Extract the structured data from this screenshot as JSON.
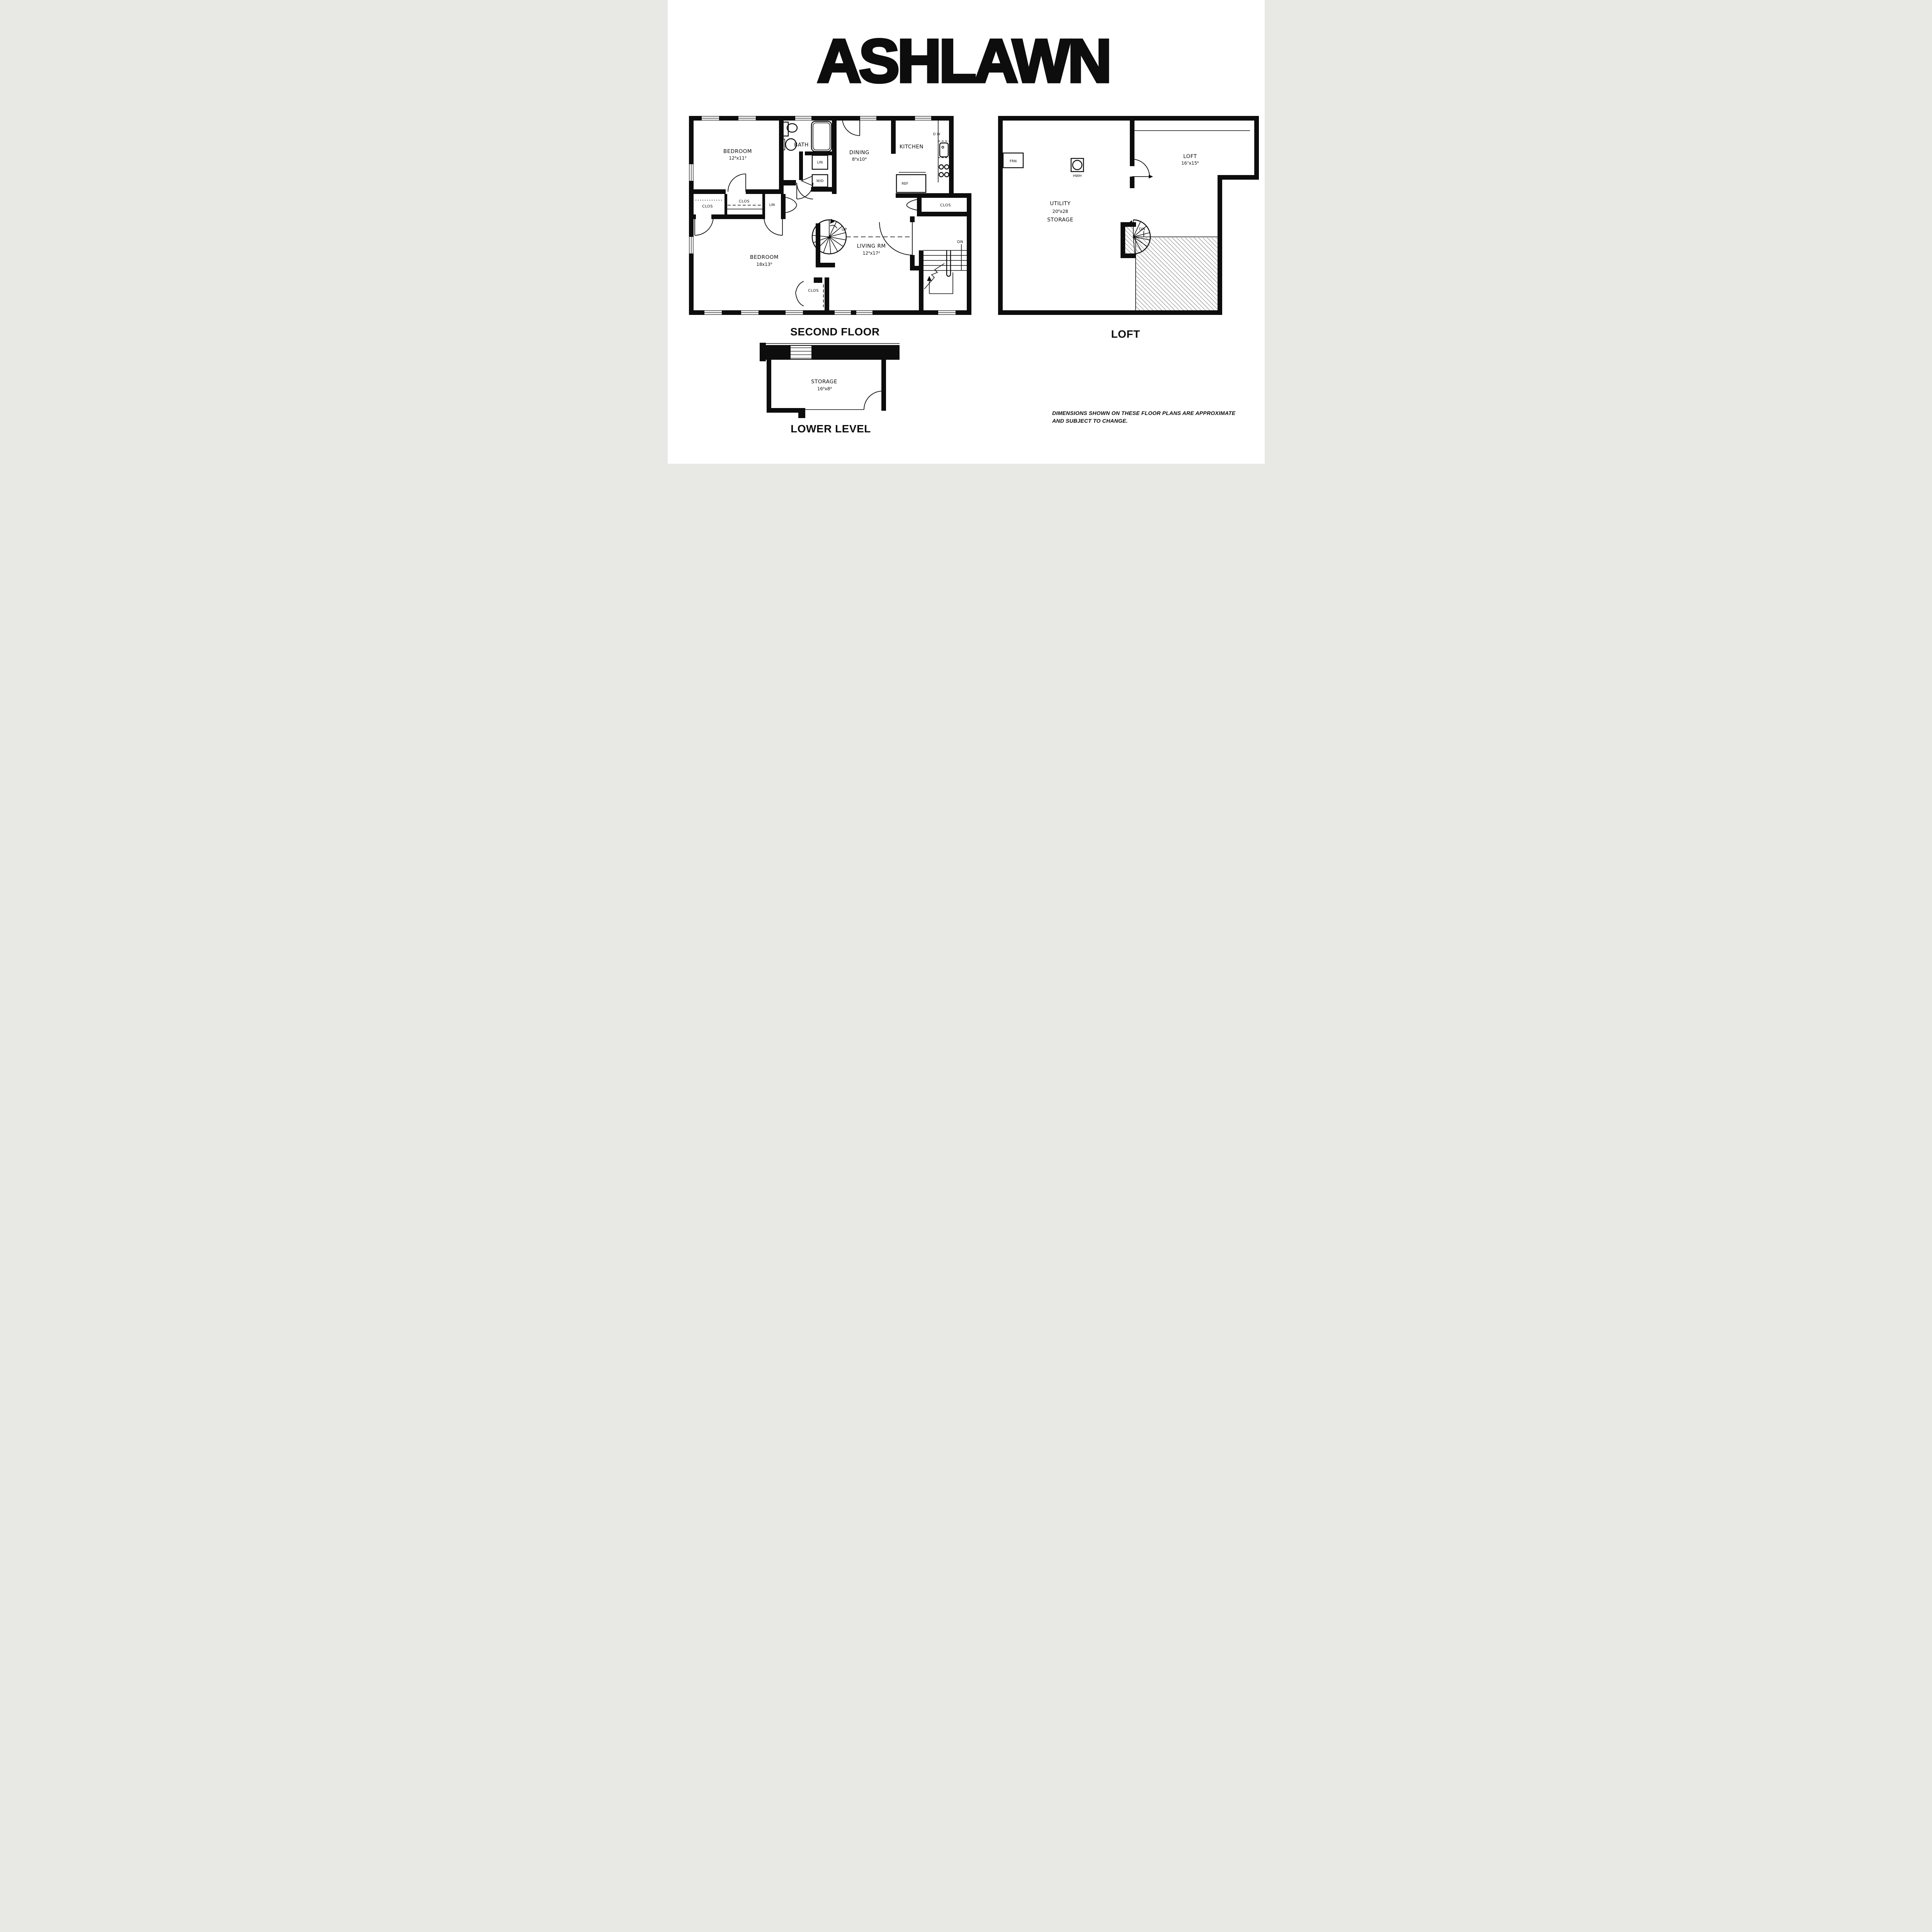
{
  "title": "ASHLAWN",
  "second_floor": {
    "label": "SECOND FLOOR",
    "bedroom1": {
      "name": "BEDROOM",
      "dims": "12⁶x11³"
    },
    "bath": {
      "name": "BATH"
    },
    "lin_upper": "LIN",
    "wd": "W/D",
    "dining": {
      "name": "DINING",
      "dims": "8⁹x10⁶"
    },
    "kitchen": {
      "name": "KITCHEN"
    },
    "dw": "D W",
    "ref": "REF",
    "clos_left": "CLOS",
    "clos_mid": "CLOS",
    "lin_mid": "LIN",
    "clos_entry": "CLOS",
    "bedroom2": {
      "name": "BEDROOM",
      "dims": "18x13⁹"
    },
    "living": {
      "name": "LIVING RM",
      "dims": "12⁶x17²"
    },
    "clos_bedroom2": "CLOS",
    "up": "UP",
    "dn": "DN"
  },
  "loft": {
    "label": "LOFT",
    "frn": "FRN",
    "hwh": "HWH",
    "utility": {
      "line1": "UTILITY",
      "dims": "20⁶x28",
      "line2": "STORAGE"
    },
    "loft_room": {
      "name": "LOFT",
      "dims": "16⁷x15⁶"
    },
    "dn": "DN"
  },
  "lower_level": {
    "label": "LOWER LEVEL",
    "storage": {
      "name": "STORAGE",
      "dims": "16⁶x8⁶"
    }
  },
  "note": {
    "line1": "DIMENSIONS SHOWN ON THESE FLOOR PLANS ARE APPROXIMATE",
    "line2": "AND SUBJECT TO CHANGE."
  },
  "colors": {
    "ink": "#0d0d0d",
    "paper": "#ffffff"
  }
}
